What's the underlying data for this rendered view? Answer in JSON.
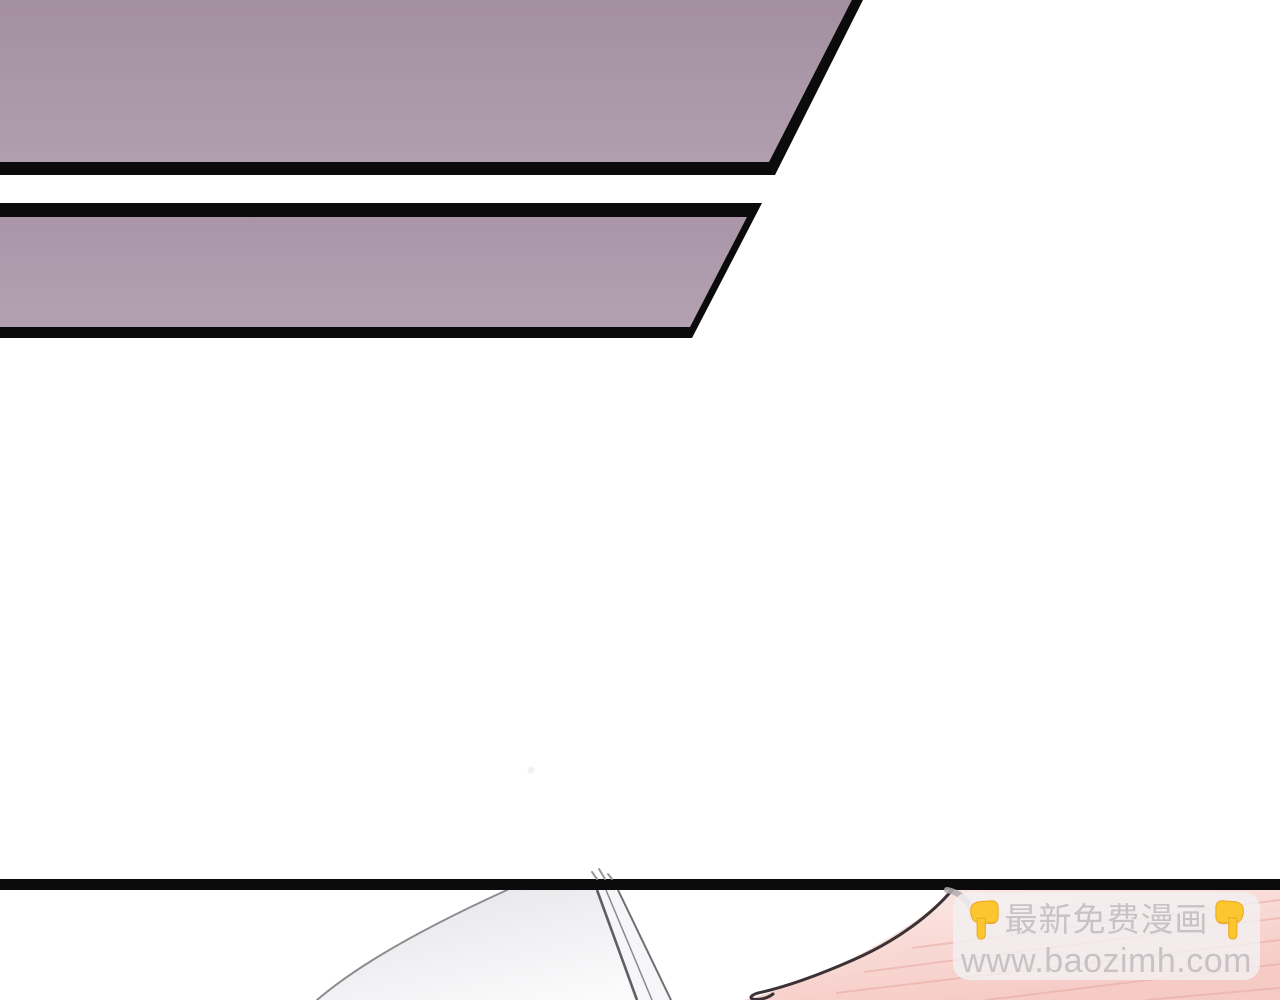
{
  "watermark": {
    "line1": "最新免费漫画",
    "line2": "www.baozimh.com",
    "text_color": "#c8c2c7",
    "box_bg": "rgba(243,240,242,0.82)",
    "emoji_name": "backhand-index-pointing-down",
    "emoji_color": "#fcc62f"
  },
  "colors": {
    "panel_border": "#0b0b0b",
    "divider_bar": "#0b0b0b",
    "panel1_top": "#a28e9f",
    "panel1_bottom": "#b09eae",
    "panel2_top": "#a995a8",
    "panel2_bottom": "#b3a1b1",
    "shade_dark": "#e5e5e9",
    "shade_light": "#fbfbfc",
    "curve_line": "#8d8d90",
    "blade_fill": "#f6f6f8",
    "blade_edge_left": "#5f5f63",
    "blade_edge_inner": "#8a8a8e",
    "blade_edge_right": "#707074",
    "tip_marks": "#97979b",
    "pink_light": "#fcebe7",
    "pink_deep": "#f6cac5",
    "stripe": "#e8a59f",
    "hair": "#3b3236",
    "crescent": "#b3acb0",
    "faint_dot": "#f2f2f5"
  }
}
